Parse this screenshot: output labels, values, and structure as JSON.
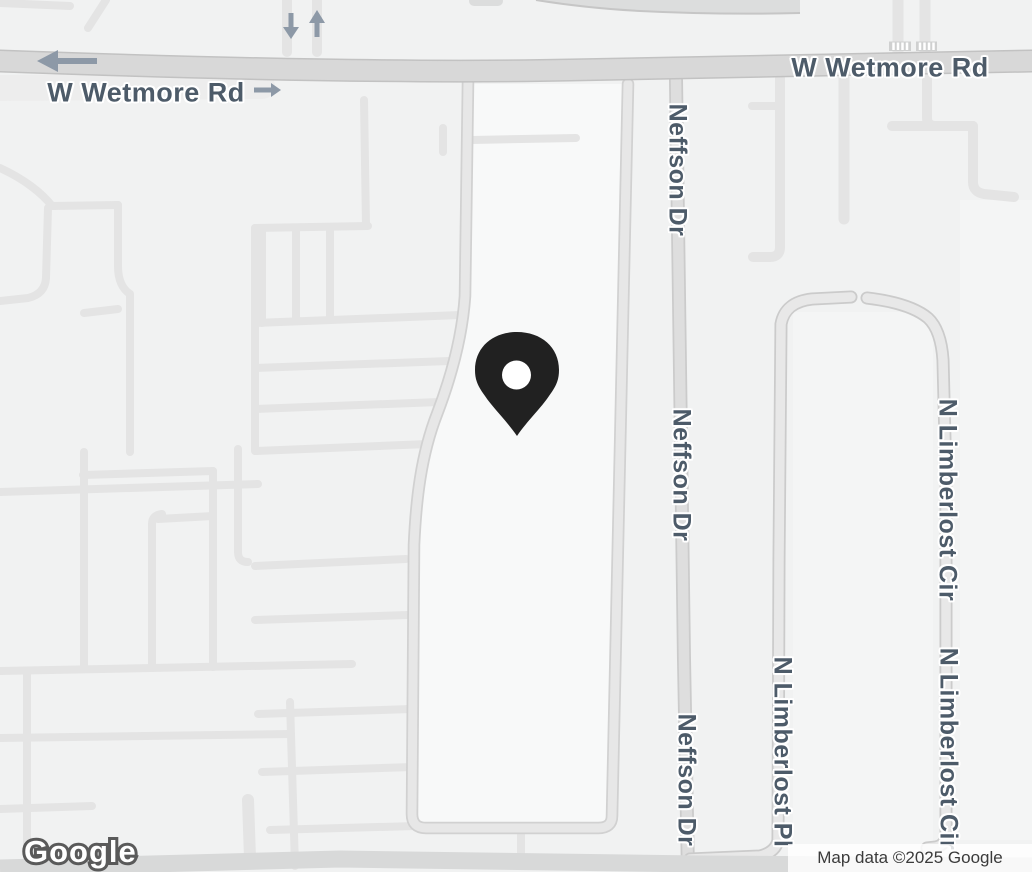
{
  "map": {
    "streets": [
      "W Wetmore Rd",
      "Neffson Dr",
      "N Limberlost Pl",
      "N Limberlost Cir"
    ],
    "road_labels": [
      {
        "id": "wetmore-1",
        "text": "W Wetmore Rd"
      },
      {
        "id": "wetmore-2",
        "text": "W Wetmore Rd"
      },
      {
        "id": "neffson-1",
        "text": "Neffson Dr"
      },
      {
        "id": "neffson-2",
        "text": "Neffson Dr"
      },
      {
        "id": "neffson-3",
        "text": "Neffson Dr"
      },
      {
        "id": "limberlost-cir-1",
        "text": "N Limberlost Cir"
      },
      {
        "id": "limberlost-pl",
        "text": "N Limberlost Pl"
      },
      {
        "id": "limberlost-cir-2",
        "text": "N Limberlost Cir"
      }
    ],
    "marker": {
      "type": "location-pin",
      "color": "#212121",
      "hole_color": "#ffffff"
    },
    "one_way_arrows": [
      {
        "direction": "left"
      },
      {
        "direction": "right"
      },
      {
        "direction": "down"
      },
      {
        "direction": "up"
      }
    ],
    "colors": {
      "background": "#f1f2f2",
      "parcel_light": "#f8f9f9",
      "minor_road": "#e4e4e4",
      "major_road_fill": "#d8d8d8",
      "major_road_casing": "#c2c2c2",
      "label_text": "#4d5b69",
      "arrow": "#8d99a7"
    }
  },
  "branding": {
    "logo_text": "Google"
  },
  "attribution": {
    "text": "Map data ©2025 Google"
  }
}
